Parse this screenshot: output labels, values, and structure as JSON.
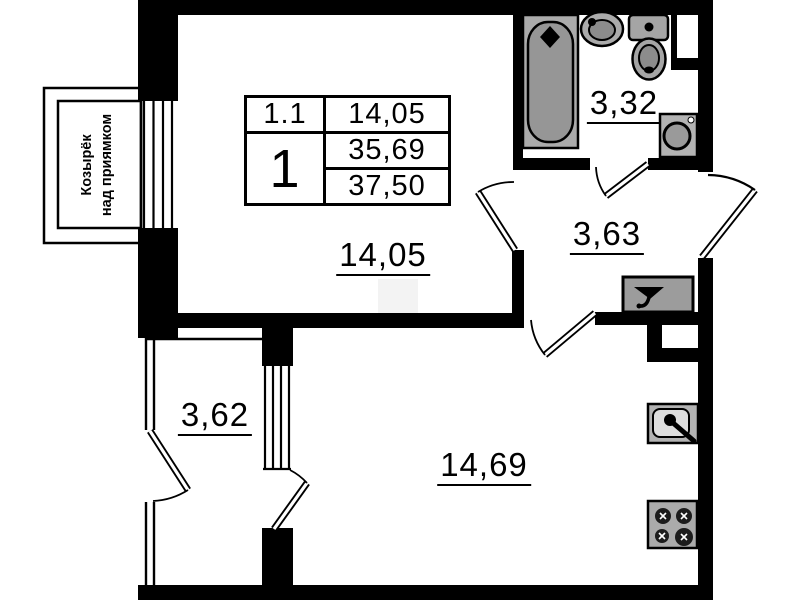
{
  "plan": {
    "unit_table": {
      "room_number": "1.1",
      "living_area": "14,05",
      "unit_number": "1",
      "area_no_balcony": "35,69",
      "total_area": "37,50"
    },
    "rooms": {
      "living": "14,05",
      "hall": "3,63",
      "bathroom": "3,32",
      "balcony": "3,62",
      "kitchen": "14,69"
    },
    "annotations": {
      "canopy_line1": "Козырёк",
      "canopy_line2": "над приямком"
    },
    "colors": {
      "wall": "#000000",
      "fixture_gray": "#ababab",
      "fixture_dark": "#8f8f8f",
      "background": "#ffffff"
    },
    "fixture_icons": {
      "bathtub": "bathtub-icon",
      "bathroom_sink": "bathroom-sink-icon",
      "toilet": "toilet-icon",
      "washing_machine": "washing-machine-icon",
      "vent_fan": "vent-fan-icon",
      "kitchen_sink": "kitchen-sink-icon",
      "stove": "stove-icon"
    }
  }
}
